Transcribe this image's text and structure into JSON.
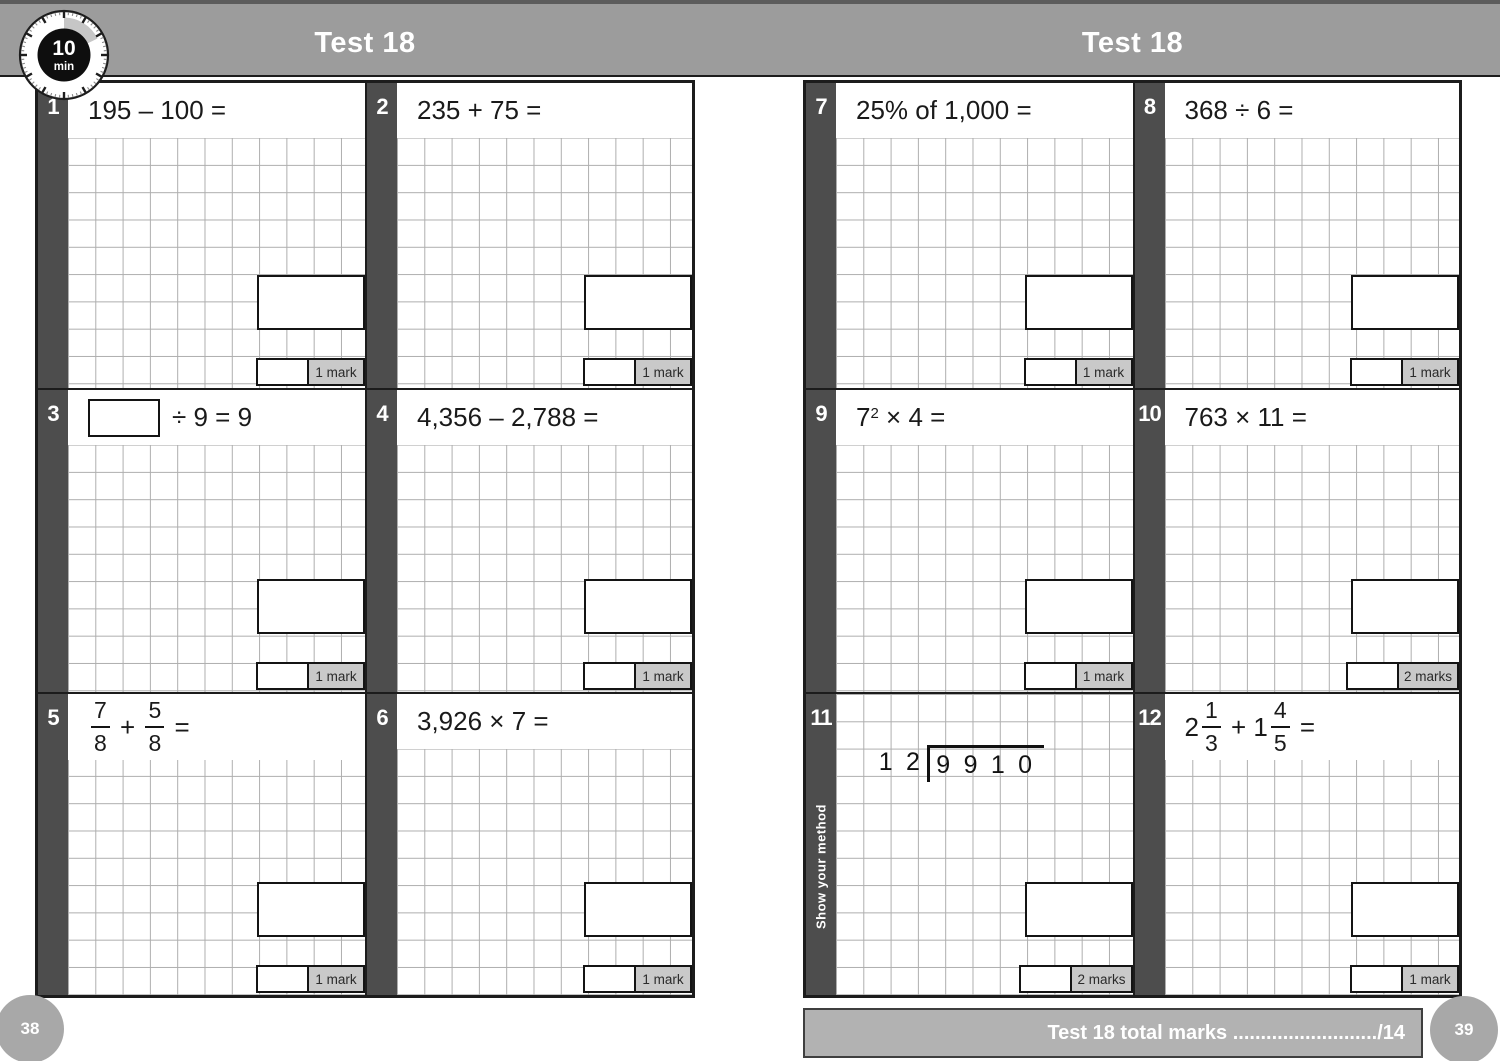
{
  "page": {
    "timer": {
      "minutes": "10",
      "unit": "min"
    },
    "left_header": "Test 18",
    "right_header": "Test 18",
    "left_page_number": "38",
    "right_page_number": "39",
    "total_bar": {
      "label": "Test 18 total marks",
      "dots": " ..........................",
      "total": "/14"
    }
  },
  "colors": {
    "header_gray": "#9c9c9c",
    "number_bar_dark": "#4d4d4d",
    "mark_label_bg": "#c9c9c9",
    "page_circle_gray": "#a8a8a8",
    "grid_line": "#aeaeae",
    "border_black": "#1c1c1c"
  },
  "questions": [
    {
      "num": "1",
      "page": "left",
      "row": 0,
      "col": 0,
      "marks": "1 mark",
      "expr": [
        {
          "t": "text",
          "v": "195 – 100 ="
        }
      ]
    },
    {
      "num": "2",
      "page": "left",
      "row": 0,
      "col": 1,
      "marks": "1 mark",
      "expr": [
        {
          "t": "text",
          "v": "235 + 75 ="
        }
      ]
    },
    {
      "num": "3",
      "page": "left",
      "row": 1,
      "col": 0,
      "marks": "1 mark",
      "expr": [
        {
          "t": "box"
        },
        {
          "t": "text",
          "v": "÷ 9 = 9"
        }
      ]
    },
    {
      "num": "4",
      "page": "left",
      "row": 1,
      "col": 1,
      "marks": "1 mark",
      "expr": [
        {
          "t": "text",
          "v": "4,356 – 2,788 ="
        }
      ]
    },
    {
      "num": "5",
      "page": "left",
      "row": 2,
      "col": 0,
      "marks": "1 mark",
      "tall_header": true,
      "expr": [
        {
          "t": "frac",
          "n": "7",
          "d": "8"
        },
        {
          "t": "text",
          "v": " + "
        },
        {
          "t": "frac",
          "n": "5",
          "d": "8"
        },
        {
          "t": "text",
          "v": " ="
        }
      ]
    },
    {
      "num": "6",
      "page": "left",
      "row": 2,
      "col": 1,
      "marks": "1 mark",
      "expr": [
        {
          "t": "text",
          "v": "3,926 × 7 ="
        }
      ]
    },
    {
      "num": "7",
      "page": "right",
      "row": 0,
      "col": 0,
      "marks": "1 mark",
      "expr": [
        {
          "t": "text",
          "v": "25% of 1,000 ="
        }
      ]
    },
    {
      "num": "8",
      "page": "right",
      "row": 0,
      "col": 1,
      "marks": "1 mark",
      "expr": [
        {
          "t": "text",
          "v": "368 ÷ 6 ="
        }
      ]
    },
    {
      "num": "9",
      "page": "right",
      "row": 1,
      "col": 0,
      "marks": "1 mark",
      "expr": [
        {
          "t": "sup",
          "b": "7",
          "e": "2"
        },
        {
          "t": "text",
          "v": " × 4 ="
        }
      ]
    },
    {
      "num": "10",
      "page": "right",
      "row": 1,
      "col": 1,
      "marks": "2 marks",
      "expr": [
        {
          "t": "text",
          "v": "763 × 11 ="
        }
      ]
    },
    {
      "num": "11",
      "page": "right",
      "row": 2,
      "col": 0,
      "marks": "2 marks",
      "no_header": true,
      "side_label": "Show your method",
      "division": {
        "divisor": [
          "1",
          "2"
        ],
        "dividend": [
          "9",
          "9",
          "1",
          "0"
        ]
      }
    },
    {
      "num": "12",
      "page": "right",
      "row": 2,
      "col": 1,
      "marks": "1 mark",
      "tall_header": true,
      "expr": [
        {
          "t": "mixed",
          "w": "2",
          "n": "1",
          "d": "3"
        },
        {
          "t": "text",
          "v": " + "
        },
        {
          "t": "mixed",
          "w": "1",
          "n": "4",
          "d": "5"
        },
        {
          "t": "text",
          "v": " ="
        }
      ]
    }
  ]
}
